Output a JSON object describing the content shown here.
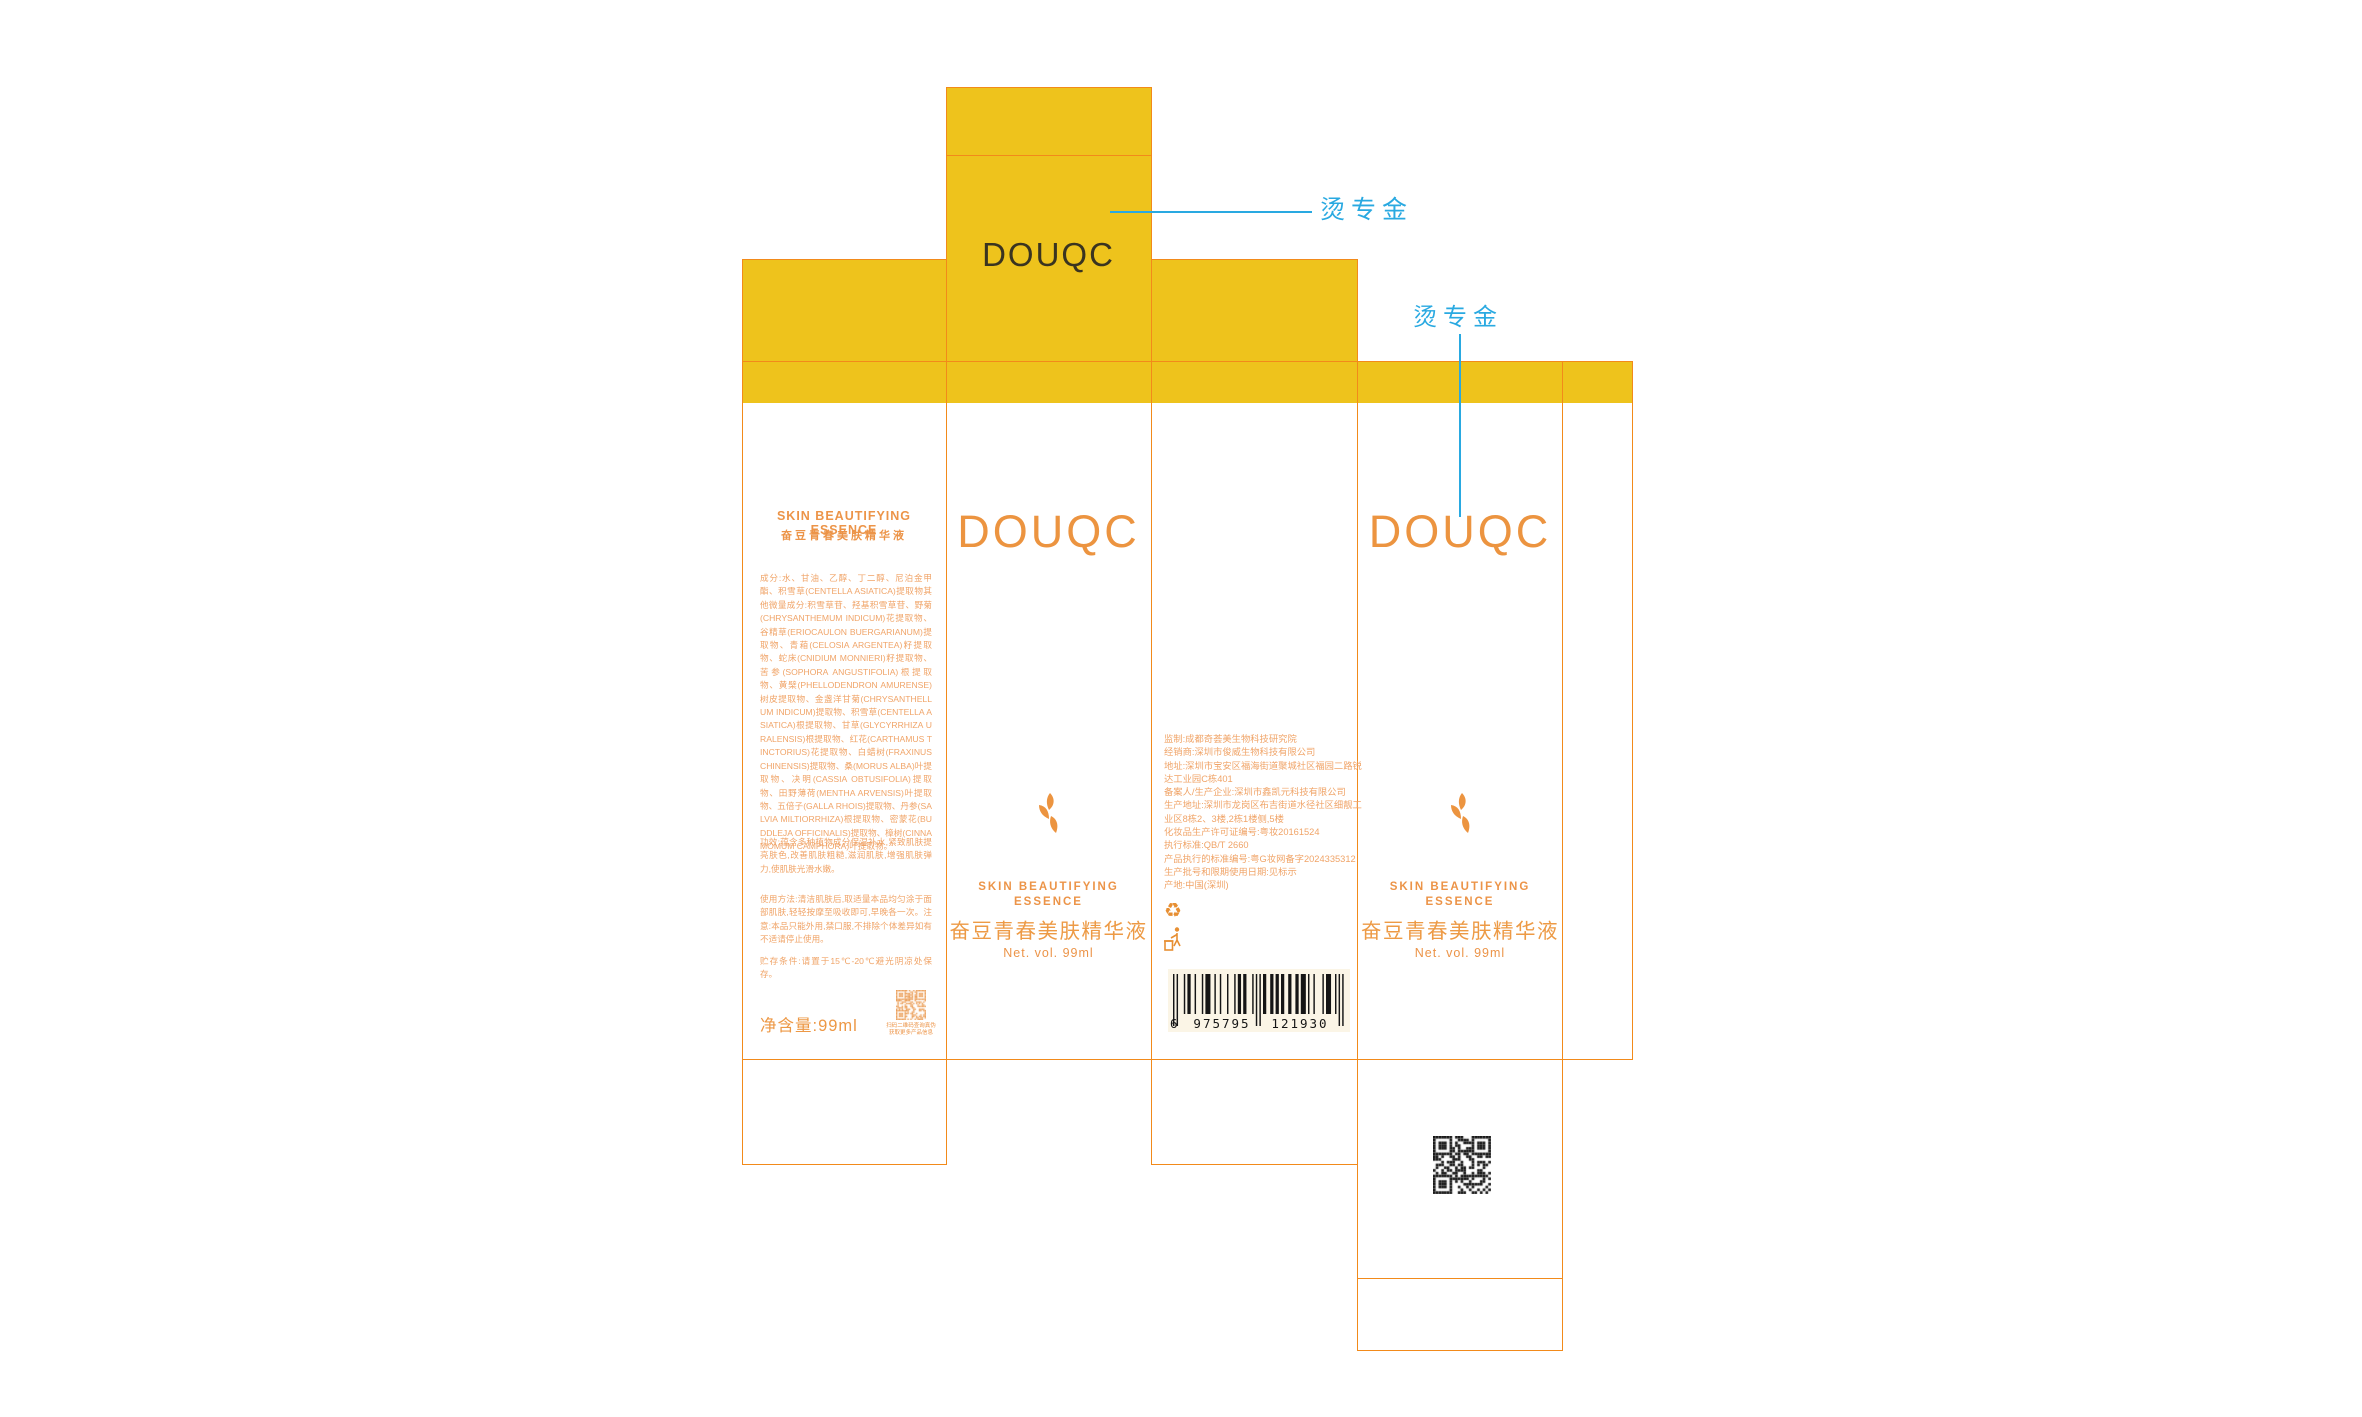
{
  "brand": {
    "logo": "DOUQC"
  },
  "annotations": {
    "foil_note_1": "烫专金",
    "foil_note_2": "烫专金"
  },
  "back_panel": {
    "title_en": "SKIN BEAUTIFYING ESSENCE",
    "title_cn": "奋豆青春美肤精华液",
    "ingredients": "成分:水、甘油、乙醇、丁二醇、尼泊金甲酯、积雪草(CENTELLA ASIATICA)提取物其他微量成分:积雪草苷、羟基积雪草苷、野菊(CHRYSANTHEMUM INDICUM)花提取物、谷精草(ERIOCAULON BUERGARIANUM)提取物、青葙(CELOSIA ARGENTEA)籽提取物、蛇床(CNIDIUM MONNIERI)籽提取物、苦参(SOPHORA ANGUSTIFOLIA)根提取物、黄檗(PHELLODENDRON AMURENSE)树皮提取物、金盏洋甘菊(CHRYSANTHELLUM INDICUM)提取物、积雪草(CENTELLA ASIATICA)根提取物、甘草(GLYCYRRHIZA URALENSIS)根提取物、红花(CARTHAMUS TINCTORIUS)花提取物、白蜡树(FRAXINUS CHINENSIS)提取物、桑(MORUS ALBA)叶提取物、决明(CASSIA OBTUSIFOLIA)提取物、田野薄荷(MENTHA ARVENSIS)叶提取物、五倍子(GALLA RHOIS)提取物、丹参(SALVIA MILTIORRHIZA)根提取物、密蒙花(BUDDLEJA OFFICINALIS)提取物、樟树(CINNAMOMUM CAMPHORA)叶提取物。",
    "efficacy": "功效:蕴含多种植物成分保湿补水,紧致肌肤提亮肤色,改善肌肤粗糙,滋润肌肤,增强肌肤弹力,使肌肤光滑水嫩。",
    "usage": "使用方法:清洁肌肤后,取适量本品均匀涂于面部肌肤,轻轻按摩至吸收即可,早晚各一次。注意:本品只能外用,禁口服,不排除个体差异如有不适请停止使用。",
    "storage": "贮存条件:请置于15℃-20℃避光阴凉处保存。",
    "qr_caption_1": "扫码二维码查询真伪",
    "qr_caption_2": "获取更多产品信息",
    "net_content": "净含量:99ml"
  },
  "front_panel": {
    "logo": "DOUQC",
    "tagline_1": "SKIN BEAUTIFYING",
    "tagline_2": "ESSENCE",
    "product_name": "奋豆青春美肤精华液",
    "net_vol": "Net. vol. 99ml"
  },
  "side_panel": {
    "info_lines": [
      "监制:成都奇荟美生物科技研究院",
      "经销商:深圳市俊威生物科技有限公司",
      "地址:深圳市宝安区福海街道聚城社区福园二路锐",
      "达工业园C栋401",
      "备案人/生产企业:深圳市鑫凯元科技有限公司",
      "生产地址:深圳市龙岗区布吉街道水径社区细靓工",
      "业区8栋2、3楼,2栋1楼侧,5楼",
      "化妆品生产许可证编号:粤妆20161524",
      "执行标准:QB/T 2660",
      "产品执行的标准编号:粤G妆网备字2024335312",
      "生产批号和限期使用日期:见标示",
      "产地:中国(深圳)"
    ],
    "barcode": {
      "value": "6975795121930",
      "digit_groups": [
        "6",
        "975795",
        "121930"
      ]
    }
  },
  "colors": {
    "gold": "#EEC31C",
    "dieline_orange": "#F28A1A",
    "text_orange": "#F0A468",
    "logo_orange": "#EC9440",
    "annotation_blue": "#29A9E1",
    "flap_logo_dark": "#3A3420"
  }
}
